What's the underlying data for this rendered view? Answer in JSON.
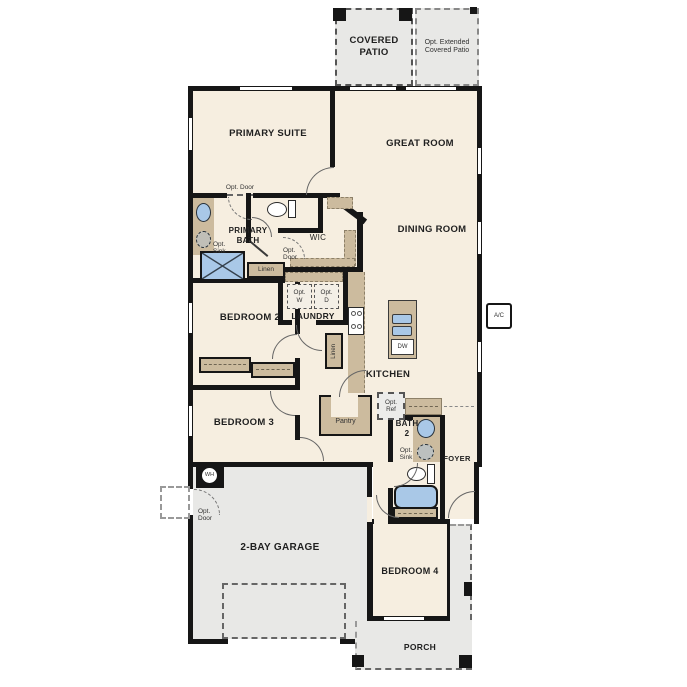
{
  "plan": {
    "labels": {
      "covered_patio": "COVERED PATIO",
      "opt_extended_patio": "Opt. Extended Covered Patio",
      "primary_suite": "PRIMARY SUITE",
      "great_room": "GREAT ROOM",
      "dining_room": "DINING ROOM",
      "primary_bath": "PRIMARY BATH",
      "wic": "WIC",
      "opt_door": "Opt. Door",
      "opt_sink": "Opt. Sink",
      "linen": "Linen",
      "laundry": "LAUNDRY",
      "opt_washer": "Opt. W",
      "opt_dryer": "Opt. D",
      "bedroom_2": "BEDROOM 2",
      "bedroom_3": "BEDROOM 3",
      "bedroom_4": "BEDROOM 4",
      "kitchen": "KITCHEN",
      "dishwasher": "DW",
      "pantry": "Pantry",
      "opt_ref": "Opt. Ref",
      "bath_2": "BATH 2",
      "foyer": "FOYER",
      "garage": "2-BAY GARAGE",
      "water_heater": "WH",
      "porch": "PORCH",
      "ac": "A/C"
    },
    "colors": {
      "floor": "#f6eee0",
      "outdoor": "#e8e8e6",
      "casework": "#ccbb9e",
      "fixture": "#a9c8e7",
      "wall": "#161616",
      "text": "#1f1f1f"
    }
  }
}
